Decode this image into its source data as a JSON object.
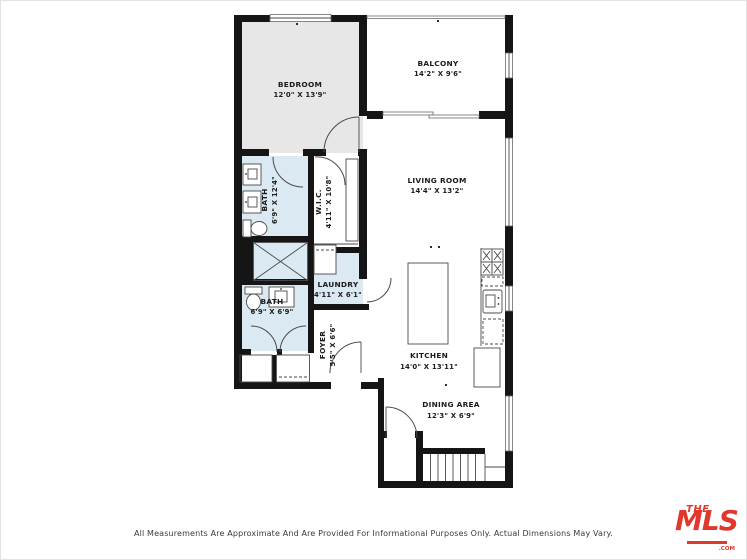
{
  "colors": {
    "wall": "#151515",
    "line": "#4a4a4a",
    "bedroom_fill": "#e7e7e7",
    "wet_room_fill": "#dbe9f3",
    "logo_red": "#df382d"
  },
  "rooms": {
    "bedroom": {
      "label": "BEDROOM",
      "dims": "12'0\" X 13'9\""
    },
    "balcony": {
      "label": "BALCONY",
      "dims": "14'2\" X 9'6\""
    },
    "living_room": {
      "label": "LIVING ROOM",
      "dims": "14'4\" X 13'2\""
    },
    "bath_primary": {
      "label": "BATH",
      "dims": "6'9\" X 12'4\""
    },
    "wic": {
      "label": "W.I.C.",
      "dims": "4'11\" X 10'8\""
    },
    "laundry": {
      "label": "LAUNDRY",
      "dims": "4'11\" X 6'1\""
    },
    "bath_second": {
      "label": "BATH",
      "dims": "6'9\" X 6'9\""
    },
    "foyer": {
      "label": "FOYER",
      "dims": "5'5\" X 6'6\""
    },
    "kitchen": {
      "label": "KITCHEN",
      "dims": "14'0\" X 13'11\""
    },
    "dining_area": {
      "label": "DINING AREA",
      "dims": "12'3\" X 6'9\""
    }
  },
  "footer": {
    "disclaimer": "All Measurements Are Approximate And Are Provided For Informational Purposes Only. Actual Dimensions May Vary."
  },
  "logo": {
    "the": "THE",
    "mls": "MLS",
    "tm": "™",
    "com": ".COM"
  }
}
